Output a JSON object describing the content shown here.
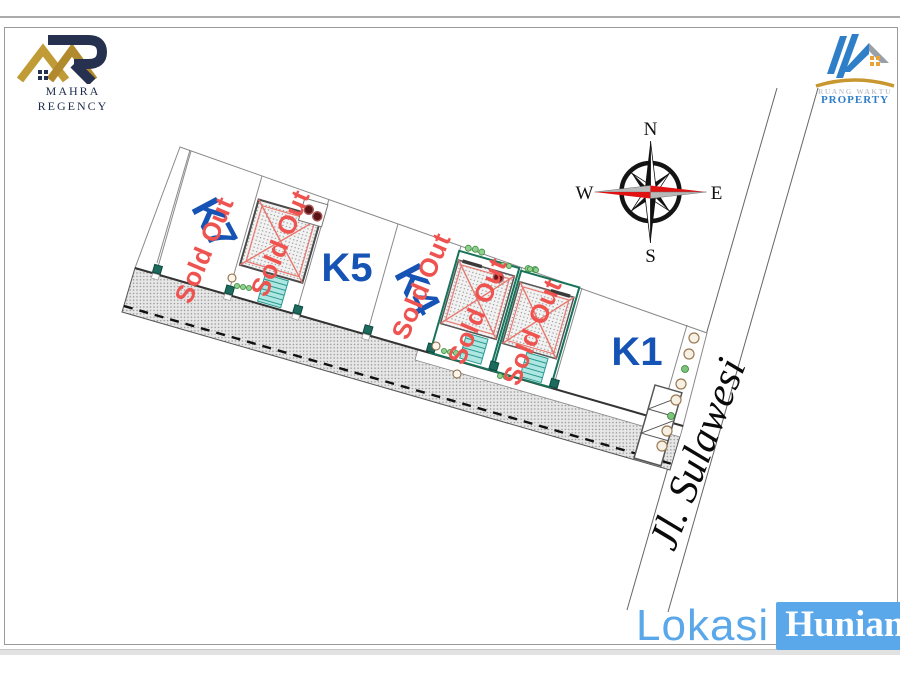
{
  "branding": {
    "mahra_regency": {
      "name": "MAHRA REGENCY"
    },
    "ruang_waktu": {
      "line1": "RUANG WAKTU",
      "line2": "PROPERTY"
    }
  },
  "compass": {
    "north": "N",
    "east": "E",
    "south": "S",
    "west": "W"
  },
  "street": {
    "name": "Jl. Sulawesi"
  },
  "footer": {
    "brand_part1": "Lokasi",
    "brand_part2": "Hunian"
  },
  "plots": [
    {
      "label": "K7",
      "status": "Sold Out"
    },
    {
      "label": "",
      "status": "Sold Out"
    },
    {
      "label": "K5",
      "status": ""
    },
    {
      "label": "K4",
      "status": "Sold Out"
    },
    {
      "label": "",
      "status": "Sold Out"
    },
    {
      "label": "",
      "status": "Sold Out"
    },
    {
      "label": "K1",
      "status": ""
    }
  ],
  "colors": {
    "plot_label_blue": "#1553b5",
    "sold_out_red": "#ef5350",
    "accent_blue": "#5aa8ea",
    "logo_navy": "#25314f",
    "logo_gold": "#c19b35",
    "stairs_teal": "#aee6e2",
    "plot_border_green": "#17735a",
    "compass_red": "#e11212"
  }
}
